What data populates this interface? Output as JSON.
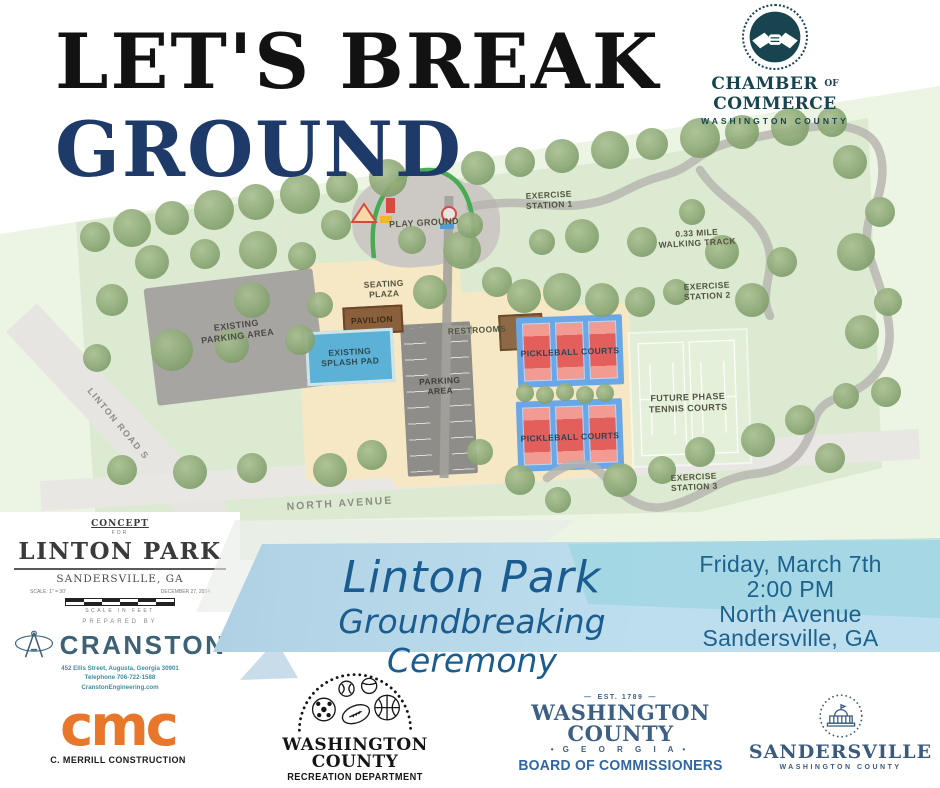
{
  "header": {
    "title_line1": "LET'S BREAK",
    "title_line2": "GROUND"
  },
  "chamber": {
    "line1_a": "CHAMBER",
    "line1_of": "OF",
    "line1_b": "COMMERCE",
    "line2": "WASHINGTON COUNTY",
    "color": "#17444e",
    "icon": "handshake-icon"
  },
  "site_plan": {
    "labels": [
      {
        "id": "playground",
        "text": "PLAY GROUND",
        "x": 424,
        "y": 223,
        "rot": -3,
        "size": 9
      },
      {
        "id": "exercise-station-1",
        "text": "EXERCISE\nSTATION 1",
        "x": 549,
        "y": 200,
        "rot": -3,
        "size": 8.5
      },
      {
        "id": "walking-track",
        "text": "0.33 MILE\nWALKING TRACK",
        "x": 697,
        "y": 238,
        "rot": -3,
        "size": 8.5
      },
      {
        "id": "exercise-station-2",
        "text": "EXERCISE\nSTATION 2",
        "x": 707,
        "y": 291,
        "rot": -3,
        "size": 8.5
      },
      {
        "id": "seating-plaza",
        "text": "SEATING\nPLAZA",
        "x": 384,
        "y": 289,
        "rot": -3,
        "size": 8.5
      },
      {
        "id": "pavilion",
        "text": "PAVILION",
        "x": 372,
        "y": 320,
        "rot": -3,
        "size": 8.5,
        "color": "#3d2b16"
      },
      {
        "id": "existing-splash-pad",
        "text": "EXISTING\nSPLASH PAD",
        "x": 350,
        "y": 357,
        "rot": -3,
        "size": 8.5,
        "color": "#2e4a52"
      },
      {
        "id": "existing-parking-area",
        "text": "EXISTING\nPARKING AREA",
        "x": 237,
        "y": 331,
        "rot": -7,
        "size": 9,
        "color": "#4b4b45"
      },
      {
        "id": "parking-area",
        "text": "PARKING\nAREA",
        "x": 440,
        "y": 386,
        "rot": -3,
        "size": 8.5,
        "color": "#3f3f39"
      },
      {
        "id": "restrooms",
        "text": "RESTROOMS",
        "x": 477,
        "y": 330,
        "rot": -3,
        "size": 8.5
      },
      {
        "id": "pickleball-courts-1",
        "text": "PICKLEBALL COURTS",
        "x": 570,
        "y": 352,
        "rot": -2,
        "size": 8.5,
        "color": "#2c4454"
      },
      {
        "id": "pickleball-courts-2",
        "text": "PICKLEBALL COURTS",
        "x": 570,
        "y": 437,
        "rot": -2,
        "size": 8.5,
        "color": "#2c4454"
      },
      {
        "id": "future-tennis-courts",
        "text": "FUTURE PHASE\nTENNIS COURTS",
        "x": 688,
        "y": 403,
        "rot": -2,
        "size": 9
      },
      {
        "id": "exercise-station-3",
        "text": "EXERCISE\nSTATION 3",
        "x": 694,
        "y": 482,
        "rot": -3,
        "size": 8.5
      },
      {
        "id": "north-avenue",
        "text": "NORTH AVENUE",
        "x": 340,
        "y": 504,
        "rot": -3.5,
        "size": 10.5,
        "color": "#8f8d84",
        "spacing": 2
      },
      {
        "id": "linton-road-s",
        "text": "LINTON ROAD S",
        "x": 118,
        "y": 424,
        "rot": 50,
        "size": 9,
        "color": "#8f8d84",
        "spacing": 1.5
      }
    ]
  },
  "concept_block": {
    "eyebrow": "CONCEPT",
    "for_word": "FOR",
    "title": "LINTON PARK",
    "city": "SANDERSVILLE, GA",
    "scale_note": "SCALE: 1\" = 30'",
    "date": "DECEMBER 27, 2024",
    "scale_in_feet": "SCALE IN FEET",
    "prepared_by": "PREPARED BY",
    "firm": "CRANSTON",
    "address": [
      "452 Ellis Street, Augusta, Georgia 30901",
      "Telephone 706-722-1588",
      "CranstonEngineering.com"
    ]
  },
  "banner": {
    "title_line1": "Linton Park",
    "title_line2": "Groundbreaking Ceremony",
    "details": [
      "Friday, March 7th",
      "2:00 PM",
      "North Avenue",
      "Sandersville, GA"
    ],
    "text_color": "#1b5c90"
  },
  "footer": {
    "cmc": {
      "mark": "cmc",
      "name": "C. MERRILL CONSTRUCTION",
      "color": "#e8762b"
    },
    "recreation": {
      "title": "WASHINGTON COUNTY",
      "subtitle": "RECREATION DEPARTMENT"
    },
    "commissioners": {
      "est": "EST. 1789",
      "title": "WASHINGTON COUNTY",
      "state": "G E O R G I A",
      "subtitle": "BOARD OF COMMISSIONERS",
      "color": "#3d5f82"
    },
    "sandersville": {
      "title": "SANDERSVILLE",
      "subtitle": "WASHINGTON COUNTY",
      "color": "#3b5a7e",
      "icon": "courthouse-icon"
    }
  }
}
